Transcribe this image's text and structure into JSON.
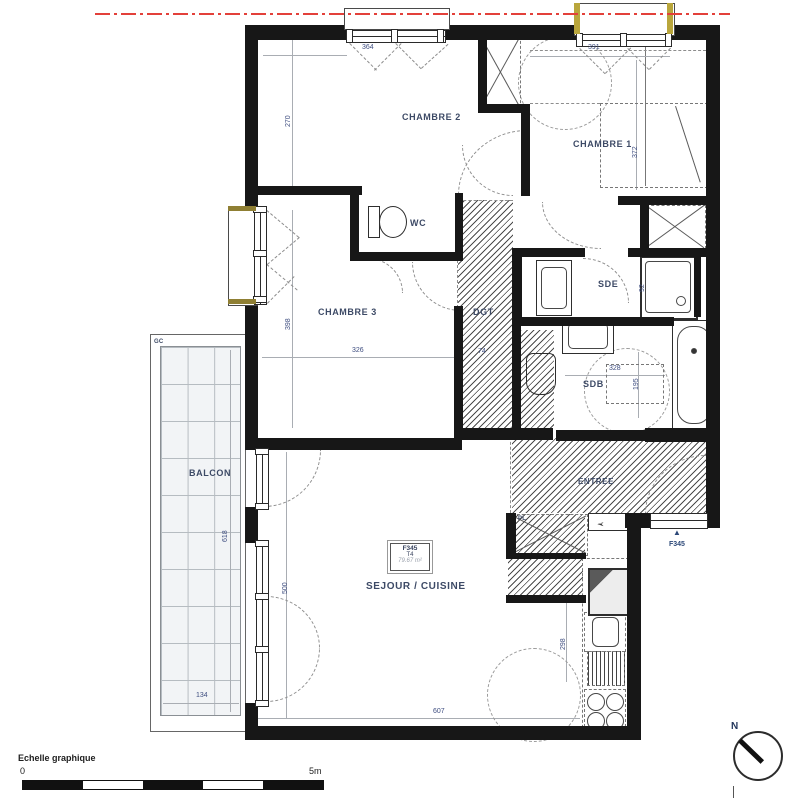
{
  "plan": {
    "rooms": {
      "chambre1": "CHAMBRE 1",
      "chambre2": "CHAMBRE 2",
      "chambre3": "CHAMBRE 3",
      "wc": "WC",
      "dgt": "DGT",
      "sde": "SDE",
      "sdb": "SDB",
      "entree": "ENTREE",
      "balcon": "BALCON",
      "sejour": "SEJOUR / CUISINE",
      "pl": "PL",
      "gc": "GC"
    },
    "dimensions": {
      "ch2_w": "364",
      "ch2_h": "270",
      "ch1_w": "391",
      "ch1_h": "372",
      "ch3_w": "326",
      "ch3_h": "398",
      "sde_h": "92",
      "sdb_w": "328",
      "sdb_h": "195",
      "balcon_w": "134",
      "balcon_h": "618",
      "sejour_w": "607",
      "sejour_h": "500",
      "kitchen_h": "298",
      "dgt_w": "74"
    },
    "unit_tag": {
      "ref": "F345",
      "type": "T4",
      "area": "79.67 m²"
    },
    "entrance_marker": {
      "label": "F345"
    },
    "scale_bar": {
      "title": "Echelle graphique",
      "start": "0",
      "end": "5m"
    },
    "compass": {
      "north": "N"
    },
    "colors": {
      "wall": "#171717",
      "boundary_line": "#e3403a",
      "room_label": "#3d4a66",
      "dimension_text": "#3f4e80",
      "window_trim_yellow": "#b9a63c",
      "window_trim_olive": "#8f7f33"
    }
  }
}
